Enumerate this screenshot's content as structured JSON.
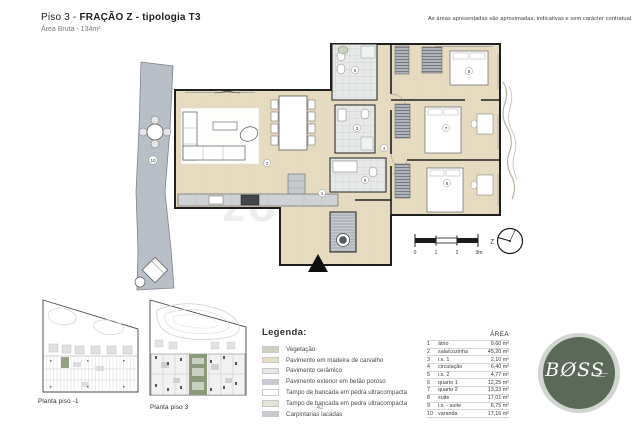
{
  "header": {
    "title_prefix": "Piso 3 - ",
    "title_bold": "FRAÇÃO Z - tipologia T3",
    "subtitle": "Área Bruta - 134m²",
    "disclaimer": "As áreas apresentadas são aproximadas, indicativas e sem carácter contratual."
  },
  "plan": {
    "watermark": "zome",
    "room_labels": [
      "1",
      "2",
      "3",
      "4",
      "5",
      "6",
      "7",
      "8",
      "9",
      "10"
    ],
    "scale_ticks": [
      "0",
      "1",
      "2",
      "3m"
    ],
    "compass_label": "Z"
  },
  "mini_plans": {
    "piso_minus1_label": "Planta piso -1",
    "piso3_label": "Planta piso 3"
  },
  "legend": {
    "title": "Legenda:",
    "items": [
      {
        "label": "Vegetação",
        "color": "#ccd3c3"
      },
      {
        "label": "Pavimento em madeira de carvalho",
        "color": "#e9ddc4"
      },
      {
        "label": "Pavimento cerâmico",
        "color": "#e8e8e8"
      },
      {
        "label": "Pavimento exterior em betão poroso",
        "color": "#c4c9d2"
      },
      {
        "label": "Tampo de bancada em pedra ultracompacta",
        "color": "#ffffff"
      },
      {
        "label": "Tampo de bancada em pedra ultracompacta",
        "color": "#e4e3d6"
      },
      {
        "label": "Carpintarias lacadas",
        "color": "#c7cad0"
      }
    ]
  },
  "area_table": {
    "header": "ÁREA",
    "rows": [
      {
        "num": "1",
        "name": "átrio",
        "area": "9,60 m²"
      },
      {
        "num": "2",
        "name": "sala/cozinha",
        "area": "45,20 m²"
      },
      {
        "num": "3",
        "name": "i.s. 1",
        "area": "2,10 m²"
      },
      {
        "num": "4",
        "name": "circulação",
        "area": "6,40 m²"
      },
      {
        "num": "5",
        "name": "i.s. 2",
        "area": "4,77 m²"
      },
      {
        "num": "6",
        "name": "quarto 1",
        "area": "12,25 m²"
      },
      {
        "num": "7",
        "name": "quarto 2",
        "area": "13,23 m²"
      },
      {
        "num": "8",
        "name": "suite",
        "area": "17,01 m²"
      },
      {
        "num": "9",
        "name": "i.s. - suite",
        "area": "6,75 m²"
      },
      {
        "num": "10",
        "name": "varanda",
        "area": "17,16 m²"
      }
    ]
  },
  "logo": {
    "text": "BØSS"
  },
  "footer": {
    "page_number": "42"
  }
}
